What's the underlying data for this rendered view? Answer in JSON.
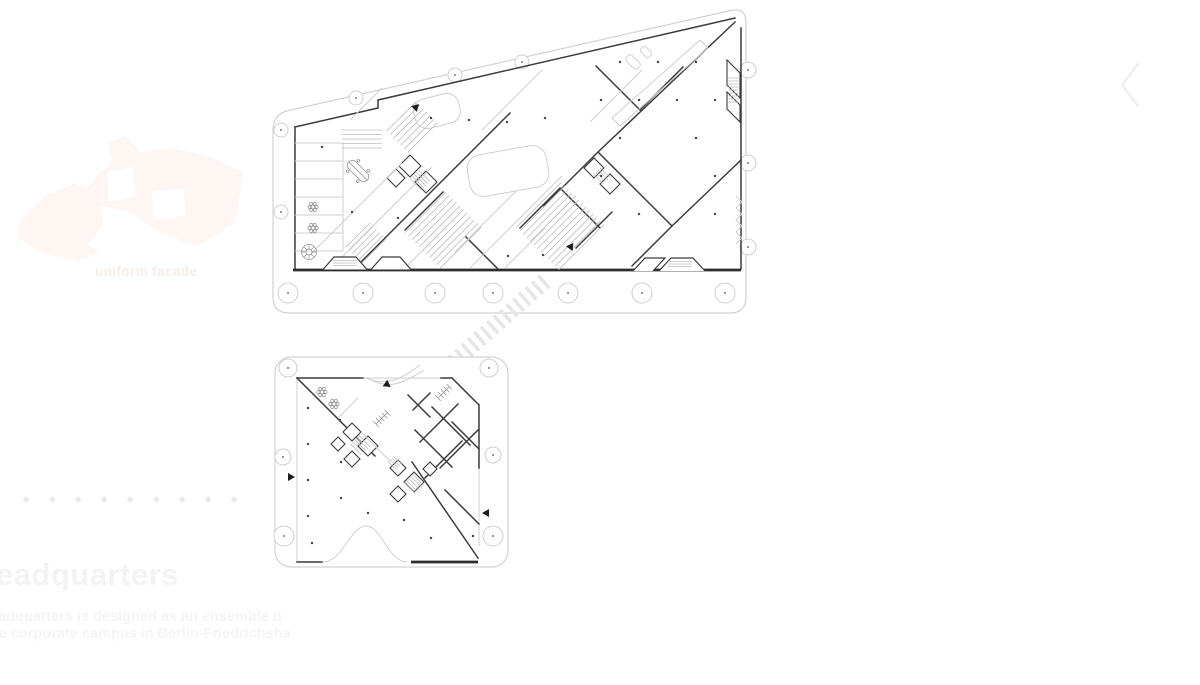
{
  "overlay": {
    "massing_caption": "uniform facade",
    "heading_visible": "eadquarters",
    "body_line1": "eadquarters is designed as an ensemble o",
    "body_line2": "he corporate campus in Berlin-Friedrichsha",
    "pager_dot_count": 9,
    "nav_chevron_direction": "left"
  },
  "colors": {
    "wall_dark": "#3b3b3b",
    "wall_heavy": "#2e2e2e",
    "line_light": "#cfcfcf",
    "boundary": "#d2d2d2",
    "hatch": "#bdbdbd",
    "dot_marker": "#4a4a4a",
    "column_stroke": "#cfcfcf",
    "column_dot": "#8f8f8f",
    "stripe_fill": "#e6e6e6",
    "massing_fill": "#fdf6f3",
    "faint_text": "#f4f3f3",
    "chevron": "#edf0f2"
  },
  "drawing": {
    "columns": {
      "large": [
        [
          288,
          293,
          10
        ],
        [
          363,
          293,
          10
        ],
        [
          435,
          293,
          10
        ],
        [
          493,
          293,
          10
        ],
        [
          568,
          293,
          10
        ],
        [
          642,
          293,
          10
        ],
        [
          725,
          293,
          10
        ],
        [
          281,
          130,
          7
        ],
        [
          281,
          212,
          7
        ],
        [
          356,
          98,
          7
        ],
        [
          455,
          75,
          7
        ],
        [
          522,
          62,
          7
        ],
        [
          748,
          70,
          8
        ],
        [
          748,
          163,
          8
        ],
        [
          748,
          247,
          8
        ]
      ],
      "small": [
        [
          288,
          368,
          9
        ],
        [
          489,
          368,
          9
        ],
        [
          283,
          457,
          8
        ],
        [
          493,
          455,
          8
        ],
        [
          284,
          536,
          10
        ],
        [
          493,
          536,
          10
        ]
      ]
    },
    "interior_dots": {
      "large": [
        [
          620,
          62
        ],
        [
          658,
          62
        ],
        [
          696,
          62
        ],
        [
          601,
          100
        ],
        [
          639,
          100
        ],
        [
          677,
          100
        ],
        [
          715,
          100
        ],
        [
          620,
          138
        ],
        [
          696,
          138
        ],
        [
          601,
          176
        ],
        [
          715,
          176
        ],
        [
          639,
          214
        ],
        [
          715,
          214
        ],
        [
          545,
          118
        ],
        [
          507,
          122
        ],
        [
          469,
          120
        ],
        [
          431,
          118
        ],
        [
          322,
          147
        ],
        [
          352,
          212
        ],
        [
          398,
          218
        ],
        [
          508,
          256
        ],
        [
          543,
          255
        ]
      ],
      "small": [
        [
          308,
          408
        ],
        [
          308,
          444
        ],
        [
          308,
          480
        ],
        [
          308,
          516
        ],
        [
          341,
          462
        ],
        [
          341,
          498
        ],
        [
          312,
          543
        ],
        [
          368,
          513
        ],
        [
          431,
          538
        ],
        [
          473,
          536
        ],
        [
          404,
          520
        ],
        [
          340,
          420
        ]
      ]
    },
    "bridge": {
      "x1": 448,
      "y1": 367,
      "x2": 544,
      "y2": 282,
      "count": 16,
      "len": 17,
      "w": 3.6,
      "rot": 49
    },
    "hatches": [
      {
        "plan": "large",
        "cx": 443,
        "cy": 230,
        "len": 58,
        "gap": 5,
        "count": 11,
        "angle": -45
      },
      {
        "plan": "large",
        "cx": 560,
        "cy": 226,
        "len": 64,
        "gap": 5,
        "count": 13,
        "angle": -45
      },
      {
        "plan": "large",
        "cx": 362,
        "cy": 139,
        "len": 40,
        "gap": 4.5,
        "count": 5,
        "angle": 0
      },
      {
        "plan": "large",
        "cx": 366,
        "cy": 243,
        "len": 34,
        "gap": 4.5,
        "count": 6,
        "angle": -45
      },
      {
        "plan": "large",
        "cx": 412,
        "cy": 127,
        "len": 42,
        "gap": 5,
        "count": 7,
        "angle": -45
      },
      {
        "plan": "large",
        "cx": 420,
        "cy": 180,
        "len": 16,
        "gap": 3,
        "count": 5,
        "angle": 45
      },
      {
        "plan": "large",
        "cx": 602,
        "cy": 176,
        "len": 14,
        "gap": 3,
        "count": 4,
        "angle": 45
      },
      {
        "plan": "large",
        "cx": 733.5,
        "cy": 90,
        "len": 10,
        "gap": 3,
        "count": 9,
        "angle": 0
      },
      {
        "plan": "large",
        "cx": 345,
        "cy": 263,
        "len": 24,
        "gap": 2.6,
        "count": 3,
        "angle": 0
      },
      {
        "plan": "large",
        "cx": 680,
        "cy": 264,
        "len": 24,
        "gap": 2.6,
        "count": 3,
        "angle": 0
      },
      {
        "plan": "small",
        "cx": 360,
        "cy": 445,
        "len": 16,
        "gap": 3,
        "count": 5,
        "angle": 45
      },
      {
        "plan": "small",
        "cx": 414,
        "cy": 484,
        "len": 16,
        "gap": 3,
        "count": 5,
        "angle": 45
      },
      {
        "plan": "small",
        "cx": 395,
        "cy": 463,
        "len": 12,
        "gap": 2.5,
        "count": 4,
        "angle": 45
      }
    ],
    "symbols": [
      {
        "type": "flower",
        "x": 313,
        "y": 207,
        "rot": 0
      },
      {
        "type": "flower",
        "x": 313,
        "y": 228,
        "rot": 0
      },
      {
        "type": "stair-circle",
        "x": 309,
        "y": 252,
        "rot": 0
      },
      {
        "type": "table",
        "x": 358,
        "y": 171,
        "rot": 45
      },
      {
        "type": "flower",
        "x": 322,
        "y": 392,
        "rot": 0
      },
      {
        "type": "flower",
        "x": 334,
        "y": 404,
        "rot": 0
      },
      {
        "type": "ladder",
        "x": 376,
        "y": 424,
        "rot": -45
      },
      {
        "type": "ladder",
        "x": 438,
        "y": 398,
        "rot": -45
      },
      {
        "type": "arrow",
        "x": 414,
        "y": 109,
        "rot": -45
      },
      {
        "type": "arrow",
        "x": 573,
        "y": 247,
        "rot": 185
      },
      {
        "type": "arrow",
        "x": 385,
        "y": 383,
        "rot": 35
      },
      {
        "type": "arrow",
        "x": 288,
        "y": 477,
        "rot": 0
      },
      {
        "type": "arrow",
        "x": 489,
        "y": 513,
        "rot": 180
      }
    ]
  }
}
